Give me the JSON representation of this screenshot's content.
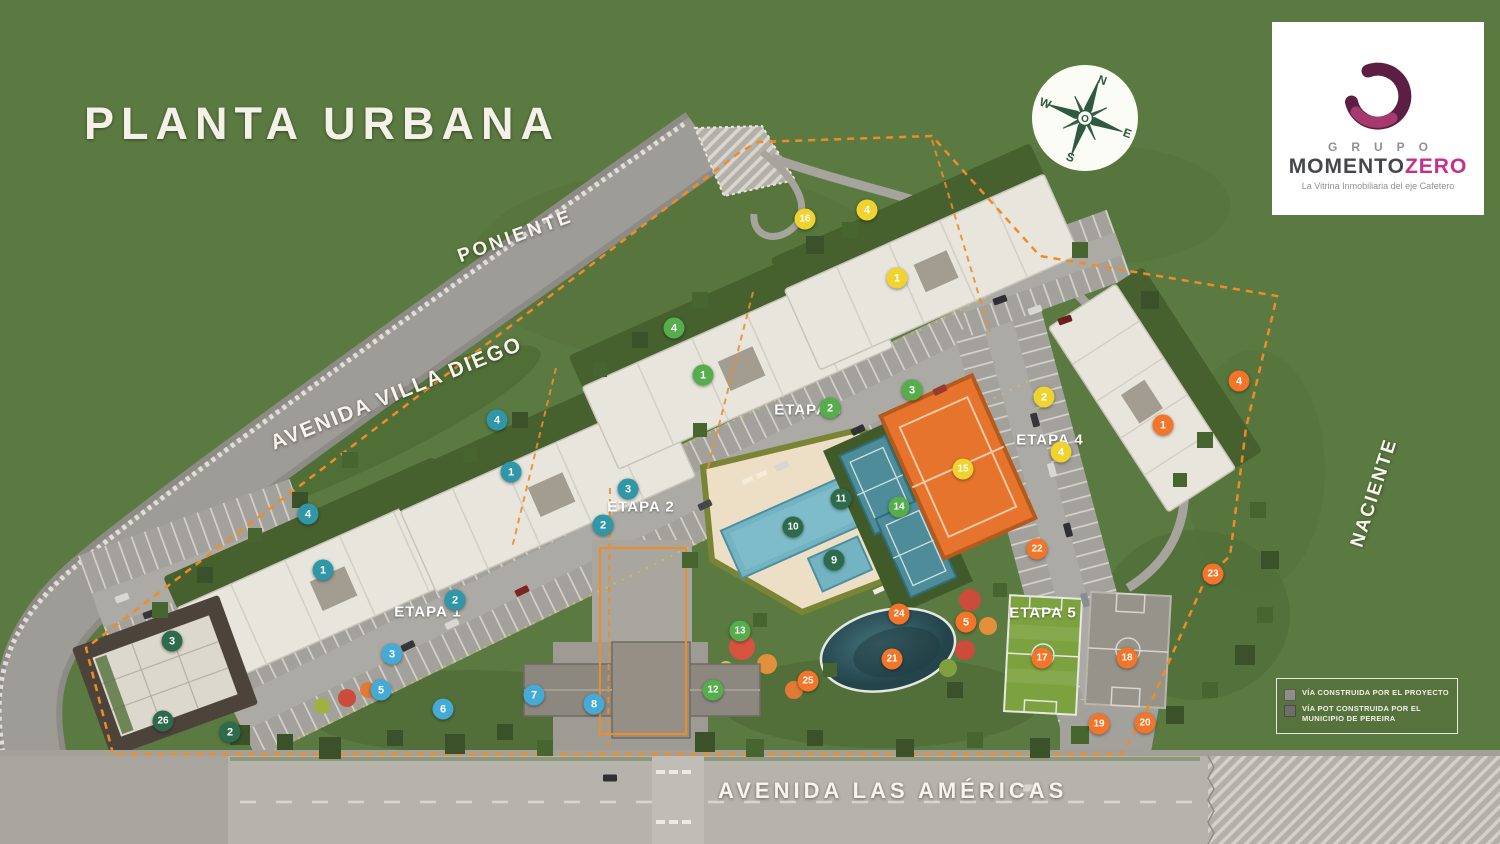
{
  "title": "PLANTA URBANA",
  "streets": {
    "poniente": "PONIENTE",
    "villa_diego": "AVENIDA VILLA DIEGO",
    "americas": "AVENIDA LAS AMÉRICAS",
    "naciente": "NACIENTE"
  },
  "compass": {
    "north": "N",
    "south": "S",
    "east": "E",
    "west": "W",
    "center": "O"
  },
  "logo": {
    "grupo": "GRUPO",
    "momento": "MOMENTO",
    "zero": "ZERO",
    "tagline": "La Vitrina Inmobiliaria del eje Cafetero",
    "brand_magenta": "#c62f8a",
    "brand_dark": "#5c1f43"
  },
  "legend": {
    "items": [
      {
        "swatch": "#908d86",
        "label": "VÍA CONSTRUIDA POR EL PROYECTO"
      },
      {
        "swatch": "#6f6d66",
        "label": "VÍA POT CONSTRUIDA POR EL MUNICIPIO DE PEREIRA"
      }
    ]
  },
  "etapas": [
    {
      "label": "ETAPA 1",
      "x": 428,
      "y": 612
    },
    {
      "label": "ETAPA 2",
      "x": 641,
      "y": 507
    },
    {
      "label": "ETAPA 3",
      "x": 808,
      "y": 410
    },
    {
      "label": "ETAPA 4",
      "x": 1050,
      "y": 440
    },
    {
      "label": "ETAPA 5",
      "x": 1043,
      "y": 613
    }
  ],
  "marker_colors": {
    "teal": "#2f97a8",
    "blue": "#45aad5",
    "green": "#56ad4c",
    "darkgreen": "#2e6b4d",
    "yellow": "#f0d32f",
    "orange": "#f2752a"
  },
  "markers": [
    {
      "n": "4",
      "x": 497,
      "y": 420,
      "c": "teal"
    },
    {
      "n": "1",
      "x": 511,
      "y": 472,
      "c": "teal"
    },
    {
      "n": "3",
      "x": 628,
      "y": 489,
      "c": "teal"
    },
    {
      "n": "2",
      "x": 603,
      "y": 525,
      "c": "teal"
    },
    {
      "n": "4",
      "x": 308,
      "y": 514,
      "c": "teal"
    },
    {
      "n": "1",
      "x": 323,
      "y": 570,
      "c": "teal"
    },
    {
      "n": "2",
      "x": 455,
      "y": 600,
      "c": "teal"
    },
    {
      "n": "3",
      "x": 392,
      "y": 654,
      "c": "blue"
    },
    {
      "n": "5",
      "x": 381,
      "y": 690,
      "c": "blue"
    },
    {
      "n": "6",
      "x": 443,
      "y": 709,
      "c": "blue"
    },
    {
      "n": "7",
      "x": 534,
      "y": 695,
      "c": "blue"
    },
    {
      "n": "8",
      "x": 594,
      "y": 704,
      "c": "blue"
    },
    {
      "n": "4",
      "x": 674,
      "y": 328,
      "c": "green"
    },
    {
      "n": "1",
      "x": 703,
      "y": 375,
      "c": "green"
    },
    {
      "n": "2",
      "x": 830,
      "y": 408,
      "c": "green"
    },
    {
      "n": "3",
      "x": 912,
      "y": 390,
      "c": "green"
    },
    {
      "n": "14",
      "x": 899,
      "y": 507,
      "c": "green"
    },
    {
      "n": "13",
      "x": 740,
      "y": 631,
      "c": "green"
    },
    {
      "n": "12",
      "x": 713,
      "y": 690,
      "c": "green"
    },
    {
      "n": "11",
      "x": 841,
      "y": 499,
      "c": "darkgreen"
    },
    {
      "n": "10",
      "x": 793,
      "y": 527,
      "c": "darkgreen"
    },
    {
      "n": "9",
      "x": 834,
      "y": 560,
      "c": "darkgreen"
    },
    {
      "n": "3",
      "x": 172,
      "y": 641,
      "c": "darkgreen"
    },
    {
      "n": "26",
      "x": 163,
      "y": 721,
      "c": "darkgreen"
    },
    {
      "n": "2",
      "x": 230,
      "y": 732,
      "c": "darkgreen"
    },
    {
      "n": "16",
      "x": 805,
      "y": 219,
      "c": "yellow"
    },
    {
      "n": "4",
      "x": 867,
      "y": 210,
      "c": "yellow"
    },
    {
      "n": "1",
      "x": 897,
      "y": 278,
      "c": "yellow"
    },
    {
      "n": "2",
      "x": 1044,
      "y": 397,
      "c": "yellow"
    },
    {
      "n": "4",
      "x": 1061,
      "y": 452,
      "c": "yellow"
    },
    {
      "n": "15",
      "x": 963,
      "y": 469,
      "c": "yellow"
    },
    {
      "n": "4",
      "x": 1239,
      "y": 381,
      "c": "orange"
    },
    {
      "n": "1",
      "x": 1163,
      "y": 425,
      "c": "orange"
    },
    {
      "n": "22",
      "x": 1037,
      "y": 549,
      "c": "orange"
    },
    {
      "n": "23",
      "x": 1213,
      "y": 574,
      "c": "orange"
    },
    {
      "n": "24",
      "x": 899,
      "y": 614,
      "c": "orange"
    },
    {
      "n": "5",
      "x": 966,
      "y": 622,
      "c": "orange"
    },
    {
      "n": "21",
      "x": 892,
      "y": 659,
      "c": "orange"
    },
    {
      "n": "25",
      "x": 808,
      "y": 681,
      "c": "orange"
    },
    {
      "n": "17",
      "x": 1042,
      "y": 658,
      "c": "orange"
    },
    {
      "n": "18",
      "x": 1127,
      "y": 658,
      "c": "orange"
    },
    {
      "n": "19",
      "x": 1099,
      "y": 724,
      "c": "orange"
    },
    {
      "n": "20",
      "x": 1145,
      "y": 723,
      "c": "orange"
    }
  ]
}
